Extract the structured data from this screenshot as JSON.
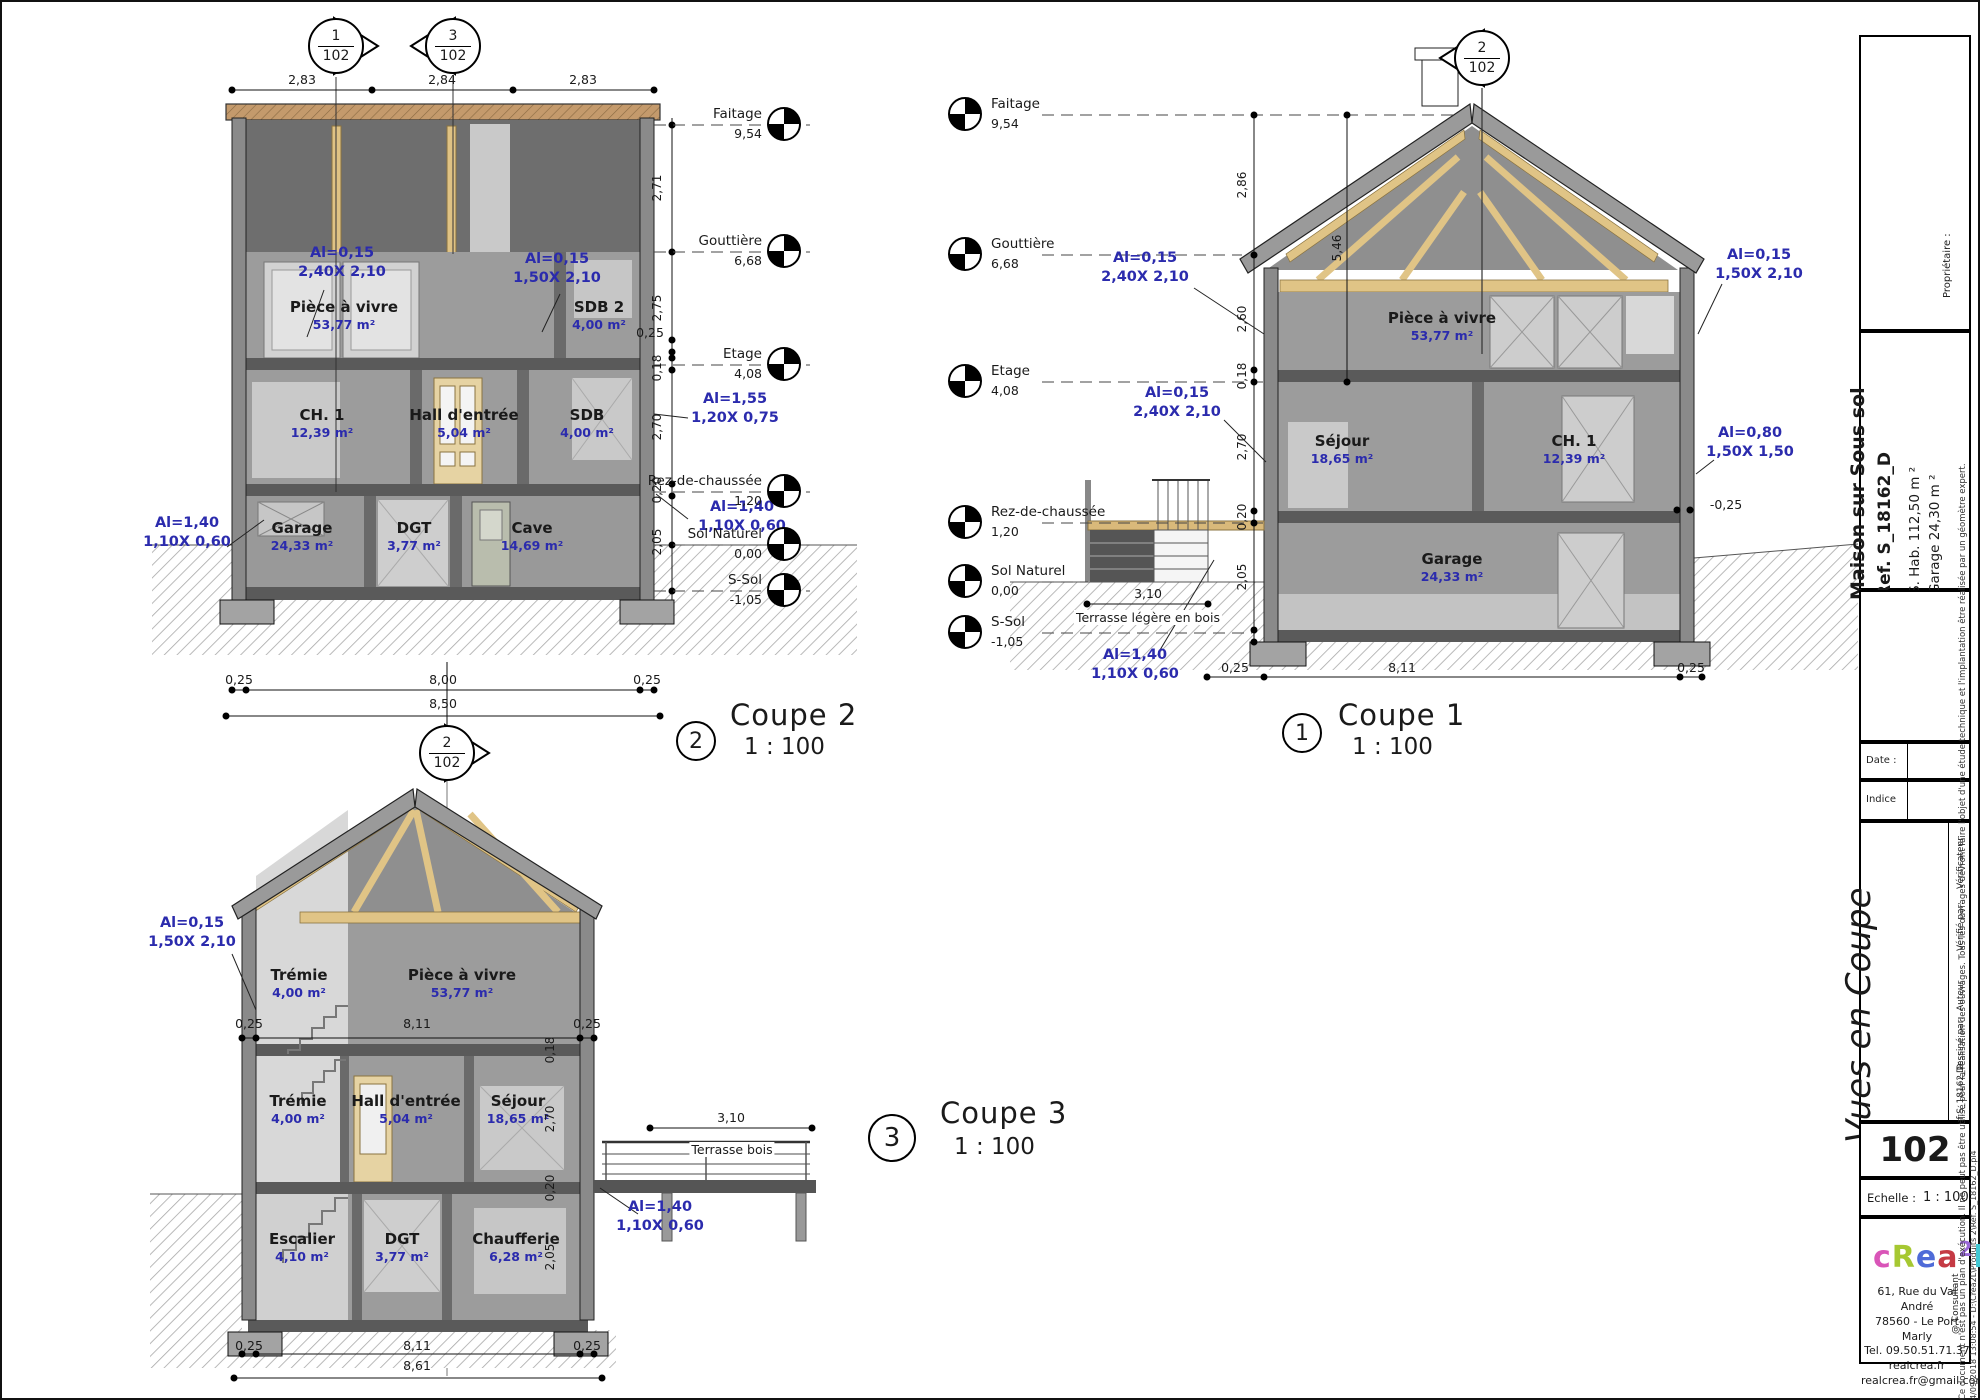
{
  "levels": [
    {
      "label": "Faitage",
      "value": "9,54"
    },
    {
      "label": "Gouttière",
      "value": "6,68"
    },
    {
      "label": "Etage",
      "value": "4,08"
    },
    {
      "label": "Rez-de-chaussée",
      "value": "1,20"
    },
    {
      "label": "Sol Naturel",
      "value": "0,00"
    },
    {
      "label": "S-Sol",
      "value": "-1,05"
    }
  ],
  "markers": {
    "m1": {
      "num": "1",
      "sheet": "102"
    },
    "m3": {
      "num": "3",
      "sheet": "102"
    },
    "m2": {
      "num": "2",
      "sheet": "102"
    },
    "mc1": {
      "num": "2",
      "sheet": "102"
    }
  },
  "coupe2": {
    "title": "Coupe 2",
    "scale": "1 : 100",
    "bubble": "2",
    "dims_top": [
      "2,83",
      "2,84",
      "2,83"
    ],
    "dims_right": {
      "r1": "2,71",
      "r2": "2,75",
      "r3": "0,25",
      "r4": "0,18",
      "r5": "2,70",
      "r6": "0,20",
      "r7": "2,05"
    },
    "dims_bottom": {
      "left": "0,25",
      "width": "8,00",
      "right": "0,25",
      "total": "8,50"
    },
    "rooms": {
      "piece": {
        "name": "Pièce à vivre",
        "area": "53,77 m²"
      },
      "sdb2": {
        "name": "SDB 2",
        "area": "4,00 m²"
      },
      "ch1": {
        "name": "CH. 1",
        "area": "12,39 m²"
      },
      "hall": {
        "name": "Hall d'entrée",
        "area": "5,04 m²"
      },
      "sdb": {
        "name": "SDB",
        "area": "4,00 m²"
      },
      "garage": {
        "name": "Garage",
        "area": "24,33 m²"
      },
      "dgt": {
        "name": "DGT",
        "area": "3,77 m²"
      },
      "cave": {
        "name": "Cave",
        "area": "14,69 m²"
      }
    },
    "ann": {
      "win_piece": "Al=0,15\n2,40X 2,10",
      "win_sdb2": "Al=0,15\n1,50X 2,10",
      "win_sdb": "Al=1,55\n1,20X 0,75",
      "win_garage": "Al=1,40\n1,10X 0,60",
      "win_rdc": "Al=1,40\n1,10X 0,60"
    }
  },
  "coupe1": {
    "title": "Coupe 1",
    "scale": "1 : 100",
    "bubble": "1",
    "dims": {
      "roof": "2,86",
      "ridge": "5,46",
      "etage_wall": "2,60",
      "slab1": "0,18",
      "rdc_wall": "2,70",
      "slab2": "0,20",
      "garage_wall": "2,05",
      "terrace": "3,10",
      "foot_l": "0,25",
      "width": "8,11",
      "foot_r": "0,25",
      "ledge": "-0,25"
    },
    "rooms": {
      "piece": {
        "name": "Pièce à vivre",
        "area": "53,77 m²"
      },
      "sejour": {
        "name": "Séjour",
        "area": "18,65 m²"
      },
      "ch1": {
        "name": "CH. 1",
        "area": "12,39 m²"
      },
      "garage": {
        "name": "Garage",
        "area": "24,33 m²"
      }
    },
    "ann": {
      "win_piece": "Al=0,15\n2,40X 2,10",
      "win_sejour": "Al=0,15\n2,40X 2,10",
      "win_right_top": "Al=0,15\n1,50X 2,10",
      "win_right_mid": "Al=0,80\n1,50X 1,50",
      "door_terrace": "Al=1,40\n1,10X 0,60"
    },
    "terrace_label": "Terrasse légère en bois"
  },
  "coupe3": {
    "title": "Coupe 3",
    "scale": "1 : 100",
    "bubble": "3",
    "dims": {
      "in_l": "0,25",
      "in_w": "8,11",
      "in_r": "0,25",
      "slab1": "0,18",
      "rdc_wall": "2,70",
      "slab2": "0,20",
      "base_wall": "2,05",
      "terrace": "3,10",
      "b_l": "0,25",
      "b_w": "8,11",
      "b_r": "0,25",
      "b_total": "8,61"
    },
    "rooms": {
      "tremie_h": {
        "name": "Trémie",
        "area": "4,00 m²"
      },
      "piece": {
        "name": "Pièce à vivre",
        "area": "53,77 m²"
      },
      "tremie": {
        "name": "Trémie",
        "area": "4,00 m²"
      },
      "hall": {
        "name": "Hall d'entrée",
        "area": "5,04 m²"
      },
      "sejour": {
        "name": "Séjour",
        "area": "18,65 m²"
      },
      "escalier": {
        "name": "Escalier",
        "area": "4,10 m²"
      },
      "dgt": {
        "name": "DGT",
        "area": "3,77 m²"
      },
      "chaufferie": {
        "name": "Chaufferie",
        "area": "6,28 m²"
      }
    },
    "ann": {
      "win_left": "Al=0,15\n1,50X 2,10",
      "door_terrace": "Al=1,40\n1,10X 0,60"
    },
    "terrace_label": "Terrasse bois"
  },
  "titleblock": {
    "proprietaire": "Propriétaire :",
    "project_name": "Maison sur Sous sol",
    "project_ref": "Ref. S_18162_D",
    "project_hab": "S. Hab.   112,50 m ²",
    "project_garage": "Garage   24,30 m ²",
    "date_label": "Date :",
    "indice_label": "Indice",
    "sheet_title": "Vues en Coupe",
    "stamp": [
      "Vérificateur",
      "Vérifié par:",
      "Auteur",
      "Dessiné par:",
      "Ref:S_18162_D"
    ],
    "sheet_number": "102",
    "echelle_label": "Echelle :",
    "echelle_value": "1 : 100",
    "consultant": "@ Consultant",
    "logo_letters": {
      "l1": "c",
      "l2": "R",
      "l3": "e",
      "l4": "a",
      "l5": "l",
      "l6": "2"
    },
    "logo_colors": [
      "#d955b8",
      "#a6c832",
      "#4f6bd8",
      "#c53a44",
      "#41c8d4",
      "#9a6ad8"
    ],
    "address": [
      "61, Rue du Val André",
      "78560 - Le Port Marly",
      "Tel. 09.50.51.71.37",
      "realcrea.fr",
      "realcrea.fr@gmail.com"
    ],
    "disclaimer1": "Ce document n'est pas un plan d'exécution. Il ne peut pas être utilisé pour la réalisation des ouvrages. Tous les ouvrages devront faire l'objet d'une étude technique et l'implantation être réalisée par un géomètre expert.",
    "disclaimer2": "04/09/2018 13:08:54 - D:\\Crea2L\\Produits 2\\Ref. S_18162_D.pl4"
  }
}
